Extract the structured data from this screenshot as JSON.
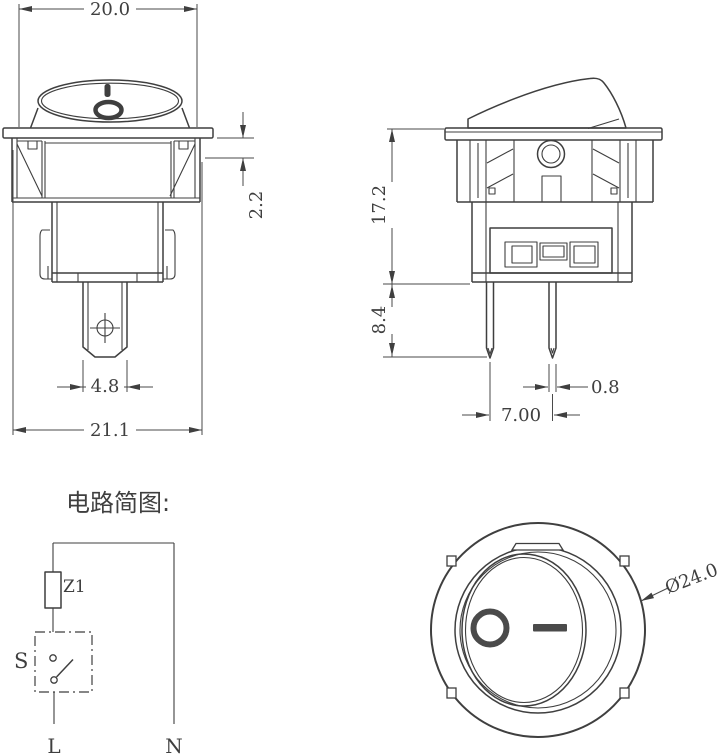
{
  "front_view": {
    "top_width": "20.0",
    "flange_to_clip": "2.2",
    "terminal_width": "4.8",
    "overall_width": "21.1",
    "rocker_marks": [
      "bar-icon",
      "ring-icon"
    ]
  },
  "side_view": {
    "body_height": "17.2",
    "pin_length": "8.4",
    "pin_thickness": "0.8",
    "pin_spacing": "7.00"
  },
  "face_view": {
    "diameter": "Ø24.0",
    "off_symbol": "O-ring-icon",
    "on_symbol": "bar-icon"
  },
  "circuit": {
    "title": "电路简图:",
    "component_label": "Z1",
    "switch_label": "S",
    "live_label": "L",
    "neutral_label": "N"
  },
  "colors": {
    "line": "#3f3f3f",
    "background": "#ffffff"
  }
}
